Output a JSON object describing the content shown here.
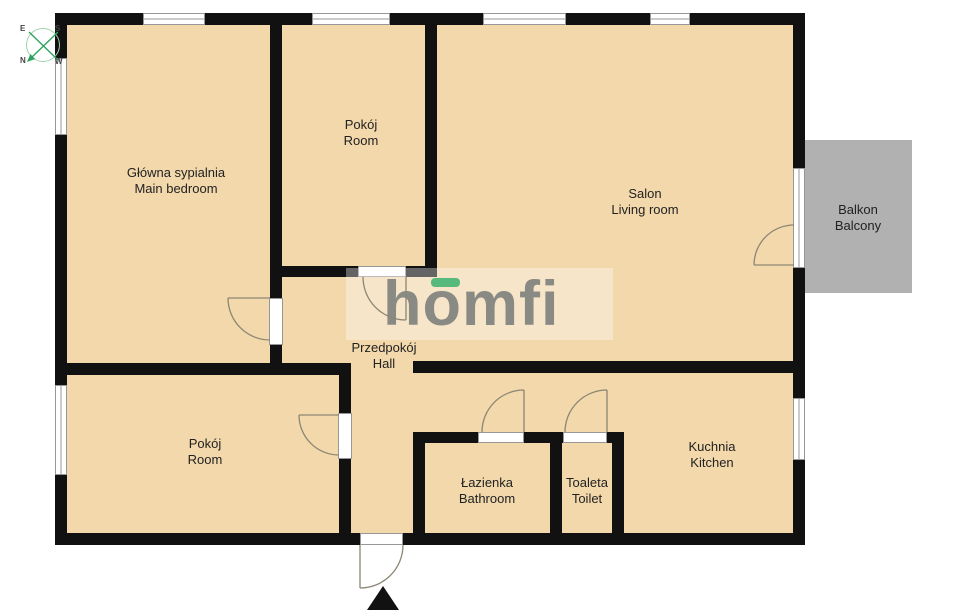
{
  "title": "Apartment floor plan",
  "colors": {
    "floor": "#f2d8ab",
    "wall": "#111111",
    "balcony_fill": "#b1b1b1",
    "window_border": "#979797",
    "door_arc": "#8c8674",
    "label_text": "#222222",
    "logo_gray": "#8a8a84",
    "logo_green": "#57b97c",
    "compass_green": "#2fa360",
    "compass_circle": "#9ed4ae"
  },
  "logo": {
    "text": "homfi"
  },
  "compass": {
    "labels": {
      "e": "E",
      "s": "S",
      "n": "N",
      "w": "W"
    }
  },
  "rooms": [
    {
      "id": "main-bedroom",
      "pl": "Główna sypialnia",
      "en": "Main bedroom"
    },
    {
      "id": "room-top",
      "pl": "Pokój",
      "en": "Room"
    },
    {
      "id": "living-room",
      "pl": "Salon",
      "en": "Living room"
    },
    {
      "id": "balcony",
      "pl": "Balkon",
      "en": "Balcony"
    },
    {
      "id": "hall",
      "pl": "Przedpokój",
      "en": "Hall"
    },
    {
      "id": "room-bottom",
      "pl": "Pokój",
      "en": "Room"
    },
    {
      "id": "bathroom",
      "pl": "Łazienka",
      "en": "Bathroom"
    },
    {
      "id": "toilet",
      "pl": "Toaleta",
      "en": "Toilet"
    },
    {
      "id": "kitchen",
      "pl": "Kuchnia",
      "en": "Kitchen"
    }
  ]
}
